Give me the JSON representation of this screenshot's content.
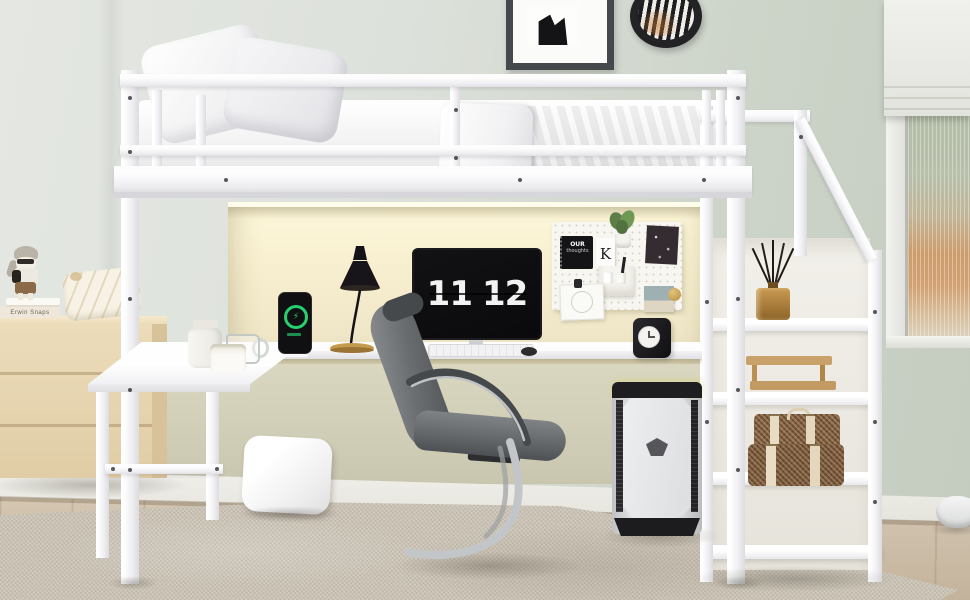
{
  "scene": {
    "type": "product-photograph",
    "description": "White metal loft bed with under-bed desk and LED-lit back panel, storage staircase with shelves, gray cantilever office chair, flip-clock monitor, gaming PC tower, pegboard organizer, light-wood dresser with toys, area rug and a window with roller shade.",
    "palette": {
      "wall_light": "#e2e5e0",
      "wall_sage": "#c6cec2",
      "led_glow": "#f9f1d3",
      "frame_white": "#f5f5f7",
      "dresser_wood": "#e7d7b5",
      "floor_wood": "#cfbea6",
      "rug": "#c9c2b4",
      "blanket_gray": "#858b8d",
      "chair_gray": "#65686a",
      "chrome": "#c3c6c9",
      "suitcase_brown": "#7b593a",
      "charge_green": "#27d06e",
      "brass": "#c59a4e",
      "lamp_black": "#17151a"
    }
  },
  "monitor": {
    "clock_hours": "11",
    "clock_minutes": "12"
  },
  "phone": {
    "charge_icon": "⚡"
  },
  "pegboard": {
    "notebook_line1": "OUR",
    "notebook_line2": "thoughts",
    "letter_card": "K"
  },
  "dresser": {
    "book_spine": "Erwin Snaps"
  },
  "inventory": [
    "loft bed",
    "guard rails",
    "white pillows",
    "gray blanket",
    "long desk",
    "l-shaped desk return",
    "black desk lamp",
    "charging smartphone",
    "flip-clock monitor",
    "white keyboard",
    "mouse",
    "white pegboard",
    "desk clock",
    "office chair",
    "gaming pc tower",
    "storage staircase",
    "reed diffuser",
    "wooden desk organizers",
    "rattan suitcases",
    "wood dresser",
    "toy figurine",
    "stacked books",
    "chevron cushion",
    "floor pillow",
    "area rug",
    "window roller shade",
    "fluted window glass",
    "portrait wall frame",
    "zebra oval frame",
    "robot vacuum"
  ]
}
